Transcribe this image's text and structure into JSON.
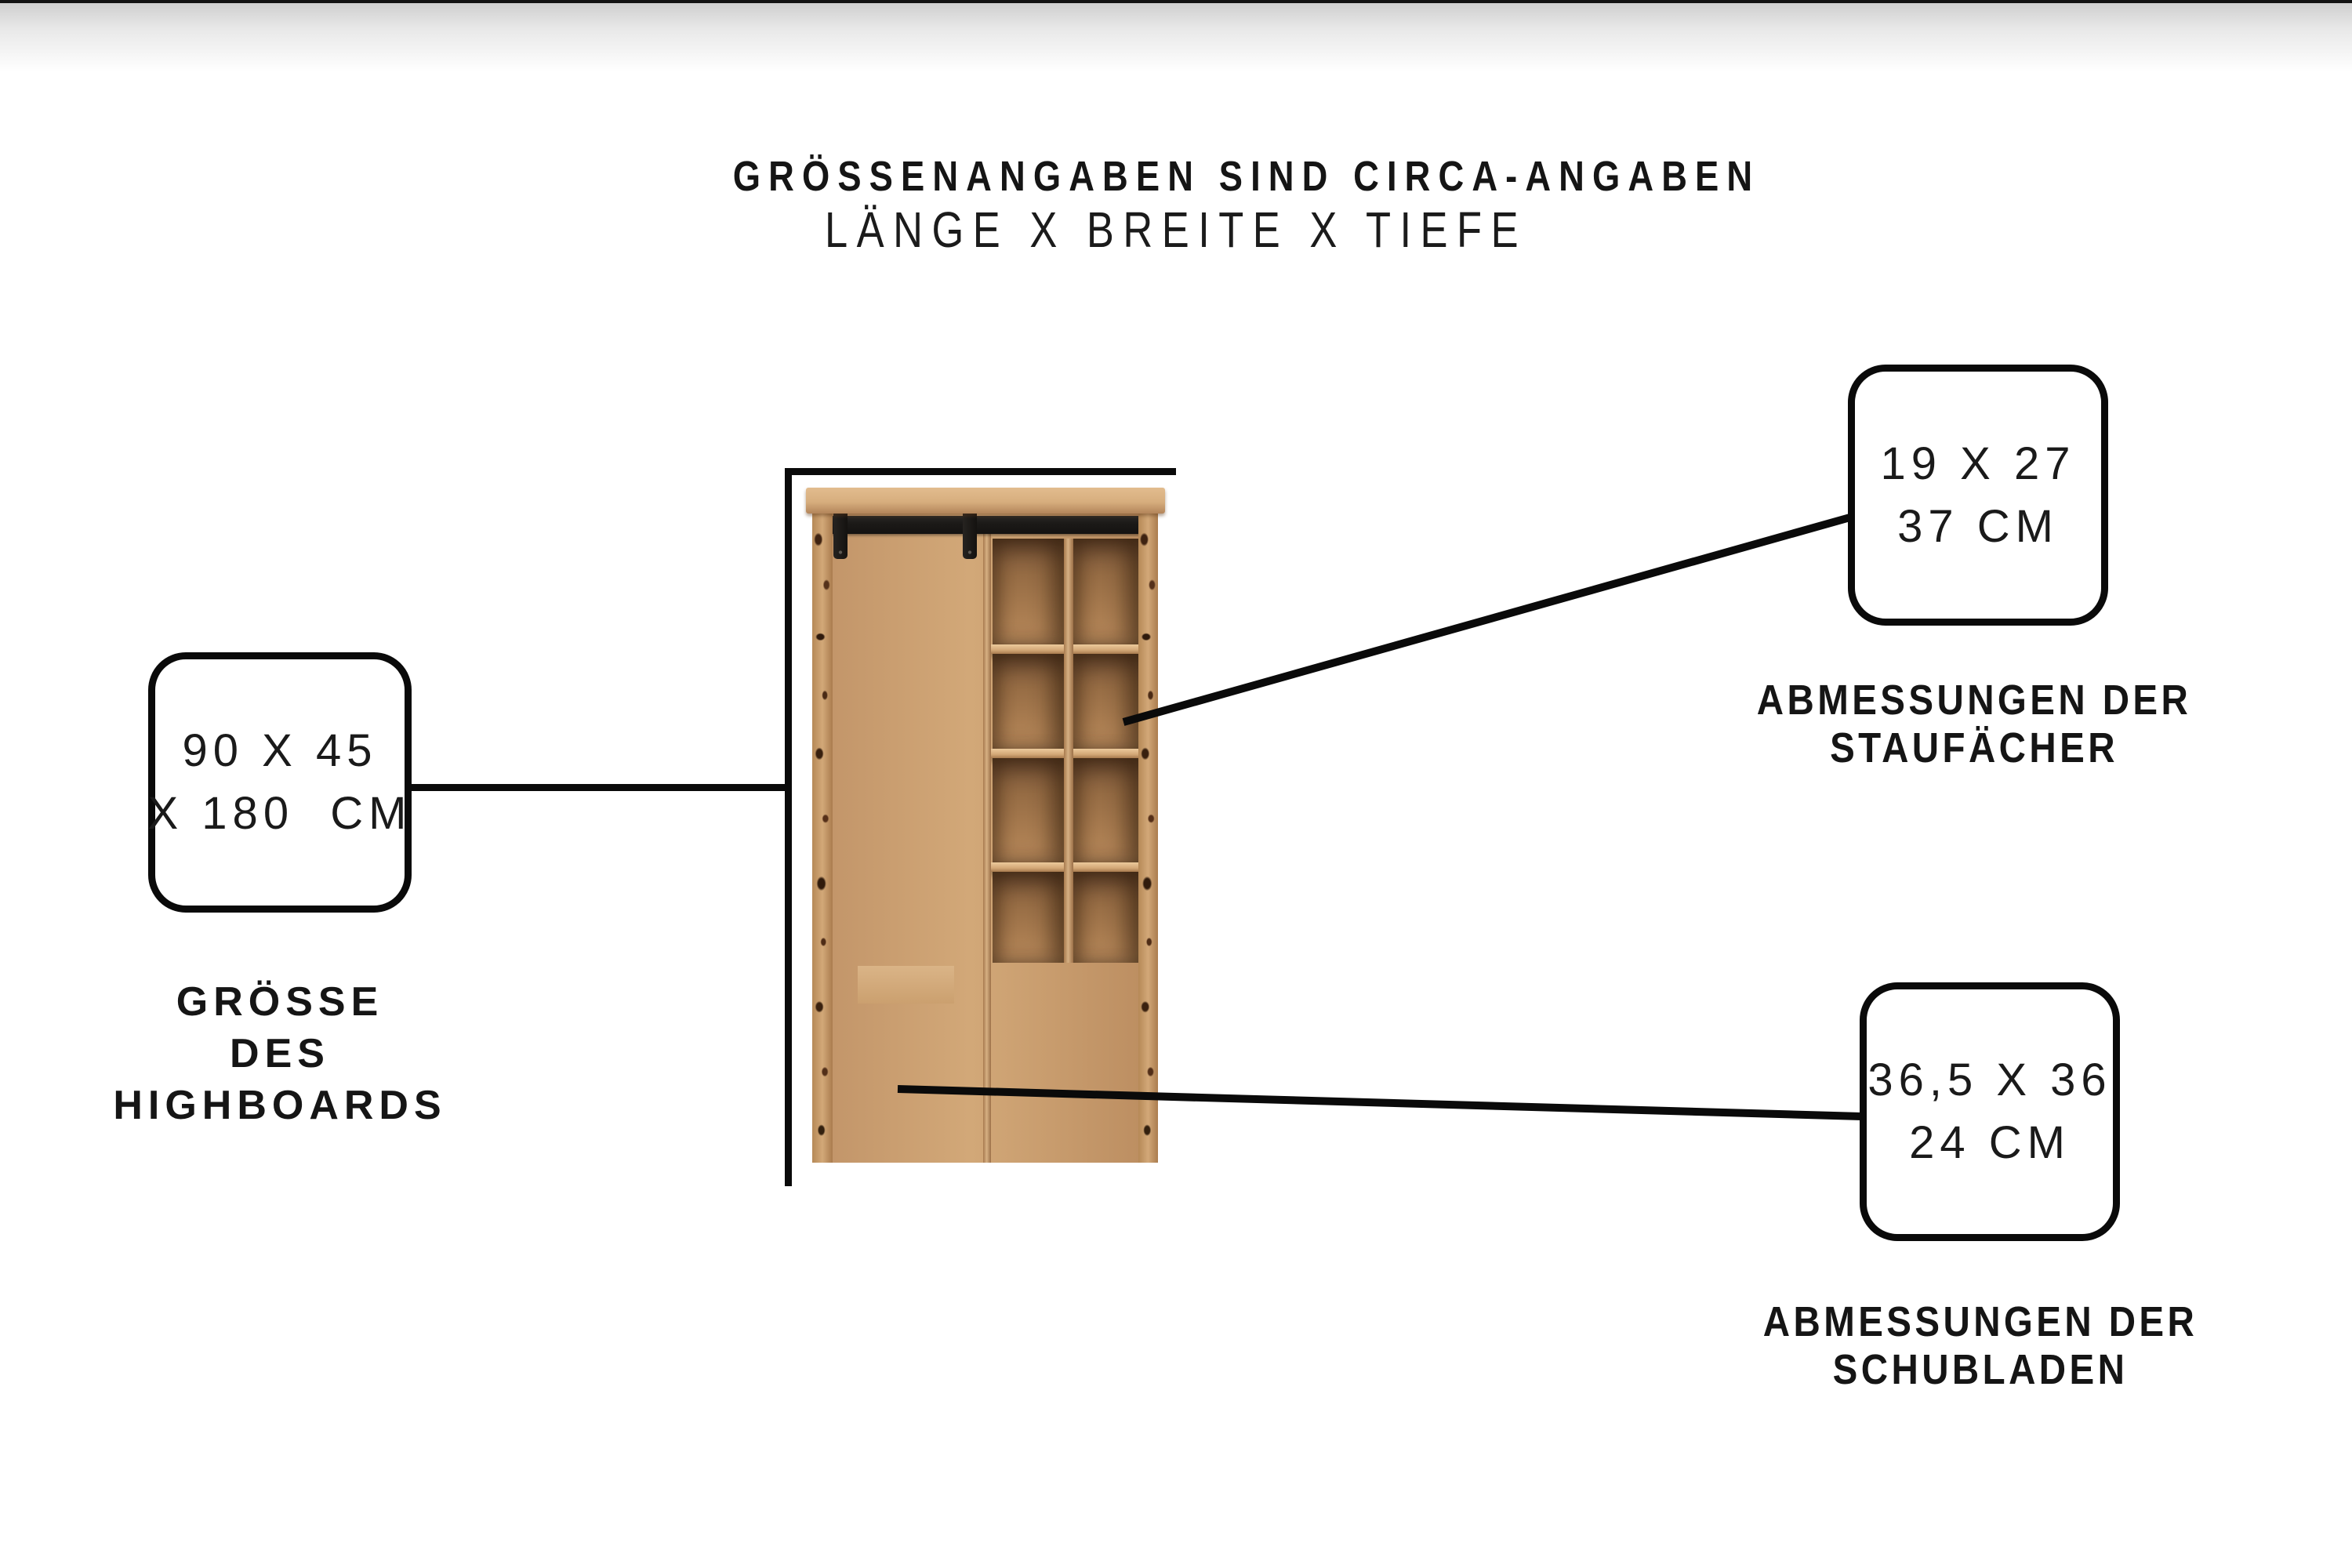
{
  "title_block": {
    "line1": "GRÖSSENANGABEN SIND CIRCA-ANGABEN",
    "line2": "LÄNGE X BREITE X TIEFE"
  },
  "callouts": {
    "highboard": {
      "value1": "90 X 45",
      "value2": "X 180  CM",
      "label1": "GRÖSSE",
      "label2": "DES",
      "label3": "HIGHBOARDS"
    },
    "compartments": {
      "value1": "19 X 27",
      "value2": "37 CM",
      "label1": "ABMESSUNGEN DER",
      "label2": "STAUFÄCHER"
    },
    "drawers": {
      "value1": "36,5 X 36",
      "value2": "24 CM",
      "label1": "ABMESSUNGEN DER",
      "label2": "SCHUBLADEN"
    }
  },
  "product": {
    "description": "massivholz-highboard-mit-schiebetuer-staufaechern-und-weinregal",
    "open_compartments": {
      "columns": 2,
      "rows": 4
    },
    "wine_rack": {
      "columns": 4,
      "rows": 5
    }
  },
  "colors": {
    "background": "#ffffff",
    "text": "#151515",
    "line_black": "#0a0a0a",
    "wood_light": "#d9b385",
    "wood_mid": "#c49a6e",
    "wood_dark": "#6b4527",
    "rail_black": "#1c1a18"
  }
}
